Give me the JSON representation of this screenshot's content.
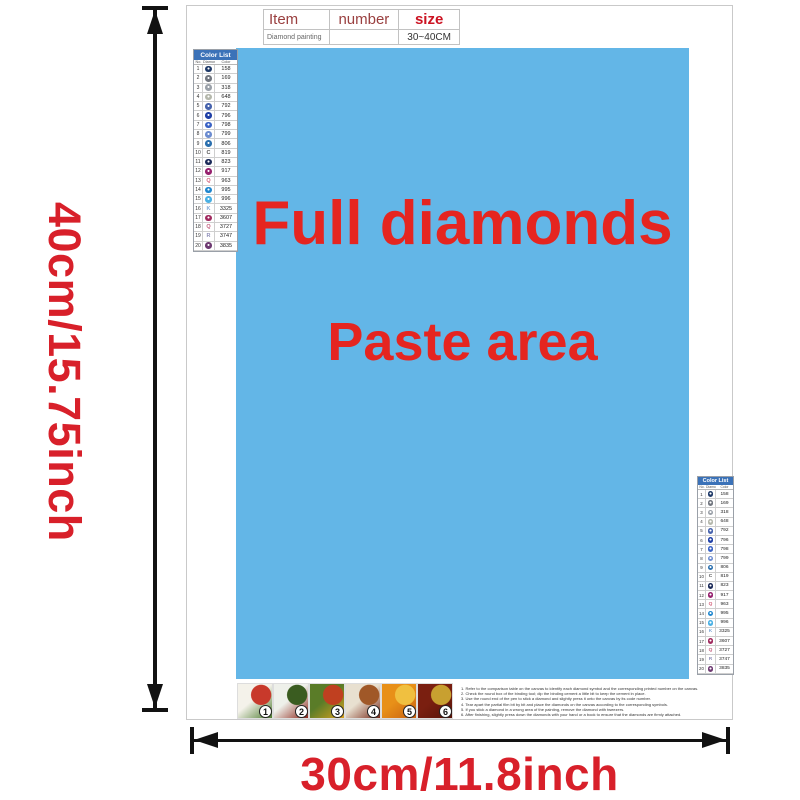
{
  "dimension_labels": {
    "height": "40cm/15.75inch",
    "width": "30cm/11.8inch"
  },
  "item_table": {
    "headers": [
      "Item",
      "number",
      "size"
    ],
    "row": {
      "item": "Diamond painting",
      "number": "",
      "size": "30~40CM"
    }
  },
  "paste_area": {
    "line1": "Full diamonds",
    "line2": "Paste area",
    "bg_color": "#63b6e7",
    "text_color": "#e52520"
  },
  "color_list": {
    "title": "Color List",
    "columns": [
      "No.",
      "Diamond",
      "Color"
    ],
    "header_bg": "#3b72b8",
    "rows": [
      {
        "no": "1",
        "symbol": "dot",
        "color": "#1f3a68",
        "code": "158"
      },
      {
        "no": "2",
        "symbol": "dot",
        "color": "#70757e",
        "code": "169"
      },
      {
        "no": "3",
        "symbol": "dot",
        "color": "#9aa0a8",
        "code": "318"
      },
      {
        "no": "4",
        "symbol": "dot",
        "color": "#b4b7ab",
        "code": "648"
      },
      {
        "no": "5",
        "symbol": "dot",
        "color": "#4662ac",
        "code": "792"
      },
      {
        "no": "6",
        "symbol": "dot",
        "color": "#1f3fa6",
        "code": "796"
      },
      {
        "no": "7",
        "symbol": "dot",
        "color": "#3a62c4",
        "code": "798"
      },
      {
        "no": "8",
        "symbol": "dot",
        "color": "#6c8cd0",
        "code": "799"
      },
      {
        "no": "9",
        "symbol": "dot",
        "color": "#2a6fae",
        "code": "806"
      },
      {
        "no": "10",
        "symbol": "C",
        "color": "#555555",
        "code": "819"
      },
      {
        "no": "11",
        "symbol": "dot",
        "color": "#1b2a58",
        "code": "823"
      },
      {
        "no": "12",
        "symbol": "dot",
        "color": "#96216e",
        "code": "917"
      },
      {
        "no": "13",
        "symbol": "Q",
        "color": "#d2607a",
        "code": "963"
      },
      {
        "no": "14",
        "symbol": "dot",
        "color": "#1e86ce",
        "code": "995"
      },
      {
        "no": "15",
        "symbol": "dot",
        "color": "#4ab0e4",
        "code": "996"
      },
      {
        "no": "16",
        "symbol": "K",
        "color": "#7fa8d8",
        "code": "3325"
      },
      {
        "no": "17",
        "symbol": "dot",
        "color": "#a0295e",
        "code": "3607"
      },
      {
        "no": "18",
        "symbol": "Q",
        "color": "#c2607e",
        "code": "3727"
      },
      {
        "no": "19",
        "symbol": "R",
        "color": "#8e8eb8",
        "code": "3747"
      },
      {
        "no": "20",
        "symbol": "dot",
        "color": "#6e3a72",
        "code": "3835"
      }
    ]
  },
  "steps": [
    {
      "num": "1",
      "colors": [
        "#f4f2ea",
        "#c8392b",
        "#4e7c30"
      ]
    },
    {
      "num": "2",
      "colors": [
        "#eef0ea",
        "#3a5c20",
        "#8c2418"
      ]
    },
    {
      "num": "3",
      "colors": [
        "#5a7c28",
        "#c04020",
        "#d8a020"
      ]
    },
    {
      "num": "4",
      "colors": [
        "#e8e0d0",
        "#a05828",
        "#782818"
      ]
    },
    {
      "num": "5",
      "colors": [
        "#e89018",
        "#f0c040",
        "#c86010"
      ]
    },
    {
      "num": "6",
      "colors": [
        "#7a1f10",
        "#c8a030",
        "#581408"
      ]
    }
  ],
  "instructions": [
    "1. Refer to the comparison table on the canvas to identify each diamond symbol and the corresponding printed number on the canvas.",
    "2. Check the round box of the binding tool; dip the binding cement a little bit to keep the cement in place.",
    "3. Use the round end of the pen to stick a diamond and slightly press it onto the canvas by its code number.",
    "4. Tear apart the partial film bit by bit and place the diamonds on the canvas according to the corresponding symbols.",
    "5. If you stick a diamond in a wrong area of the painting, remove the diamond with tweezers.",
    "6. After finishing, slightly press down the diamonds with your hand or a book to ensure that the diamonds are firmly attached."
  ],
  "colors": {
    "dimension_red": "#d8202a",
    "arrow_black": "#121212",
    "header_dark_red": "#9a4040",
    "size_red": "#cc1322"
  }
}
